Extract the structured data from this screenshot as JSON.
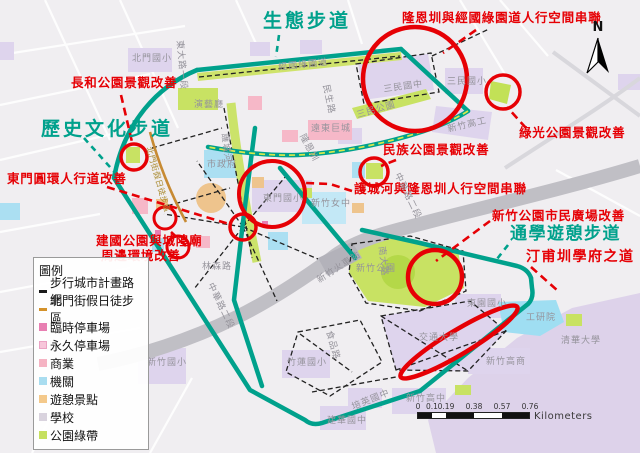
{
  "compass": {
    "label": "N"
  },
  "trails": {
    "eco": "生態步道",
    "history": "歷史文化步道",
    "commute": "通學遊憩步道"
  },
  "callouts": [
    {
      "text": "隆恩圳與經國綠園道人行空間串聯"
    },
    {
      "text": "長和公園景觀改善"
    },
    {
      "text": "東門圓環人行道改善"
    },
    {
      "text": "建國公園與城隍廟"
    },
    {
      "text": "周邊環境改善"
    },
    {
      "text": "民族公園景觀改善"
    },
    {
      "text": "護城河與隆恩圳人行空間串聯"
    },
    {
      "text": "綠光公園景觀改善"
    },
    {
      "text": "新竹公園市民廣場改善"
    },
    {
      "text": "汀甫圳學府之道"
    }
  ],
  "map_labels": [
    {
      "text": "北門國小"
    },
    {
      "text": "東大路一段"
    },
    {
      "text": "經國綠園道"
    },
    {
      "text": "民生路"
    },
    {
      "text": "三民國中"
    },
    {
      "text": "三民公園"
    },
    {
      "text": "三民國小"
    },
    {
      "text": "新竹高工"
    },
    {
      "text": "演藝廳"
    },
    {
      "text": "遠東巨城"
    },
    {
      "text": "隆恩圳"
    },
    {
      "text": "護城河"
    },
    {
      "text": "市政府"
    },
    {
      "text": "東門國小"
    },
    {
      "text": "新竹女中"
    },
    {
      "text": "中華路二段"
    },
    {
      "text": "新竹火車站"
    },
    {
      "text": "林森路"
    },
    {
      "text": "中華路二段"
    },
    {
      "text": "南大路"
    },
    {
      "text": "食品路"
    },
    {
      "text": "新竹公園"
    },
    {
      "text": "東園國小"
    },
    {
      "text": "工研院"
    },
    {
      "text": "清華大學"
    },
    {
      "text": "新竹高商"
    },
    {
      "text": "交通大學"
    },
    {
      "text": "新竹高中"
    },
    {
      "text": "建華國中"
    },
    {
      "text": "培英國中"
    },
    {
      "text": "新竹國小"
    },
    {
      "text": "竹蓮國小"
    },
    {
      "text": "北門街假日徒步區"
    }
  ],
  "legend": {
    "title": "圖例",
    "items": [
      {
        "label": "步行城市計畫路網",
        "symbol": "dash",
        "color": "#1a1a1a"
      },
      {
        "label": "北門街假日徒步區",
        "symbol": "dash",
        "color": "#d4922a"
      },
      {
        "label": "臨時停車場",
        "symbol": "square",
        "color": "#e87fb2"
      },
      {
        "label": "永久停車場",
        "symbol": "square",
        "color": "#f7c6da"
      },
      {
        "label": "商業",
        "symbol": "square",
        "color": "#f5b3c3"
      },
      {
        "label": "機關",
        "symbol": "square",
        "color": "#a9ddf0"
      },
      {
        "label": "遊憩景點",
        "symbol": "square",
        "color": "#f4c98b"
      },
      {
        "label": "學校",
        "symbol": "square",
        "color": "#d9d3de"
      },
      {
        "label": "公園綠帶",
        "symbol": "square",
        "color": "#c6e05f"
      }
    ]
  },
  "scale_bar": {
    "ticks": [
      "0",
      "0.1",
      "0.19",
      "0.38",
      "0.57",
      "0.76"
    ],
    "unit": "Kilometers"
  },
  "colors": {
    "route_teal": "#00a18c",
    "highlight_red": "#e60005",
    "park_green": "#c8e263",
    "school_purple": "#ded4ed",
    "agency_blue": "#abdff2",
    "commerce_pink": "#f6b8c8",
    "recreation_orange": "#eec48d",
    "railway_gray": "#c0bfc5"
  }
}
